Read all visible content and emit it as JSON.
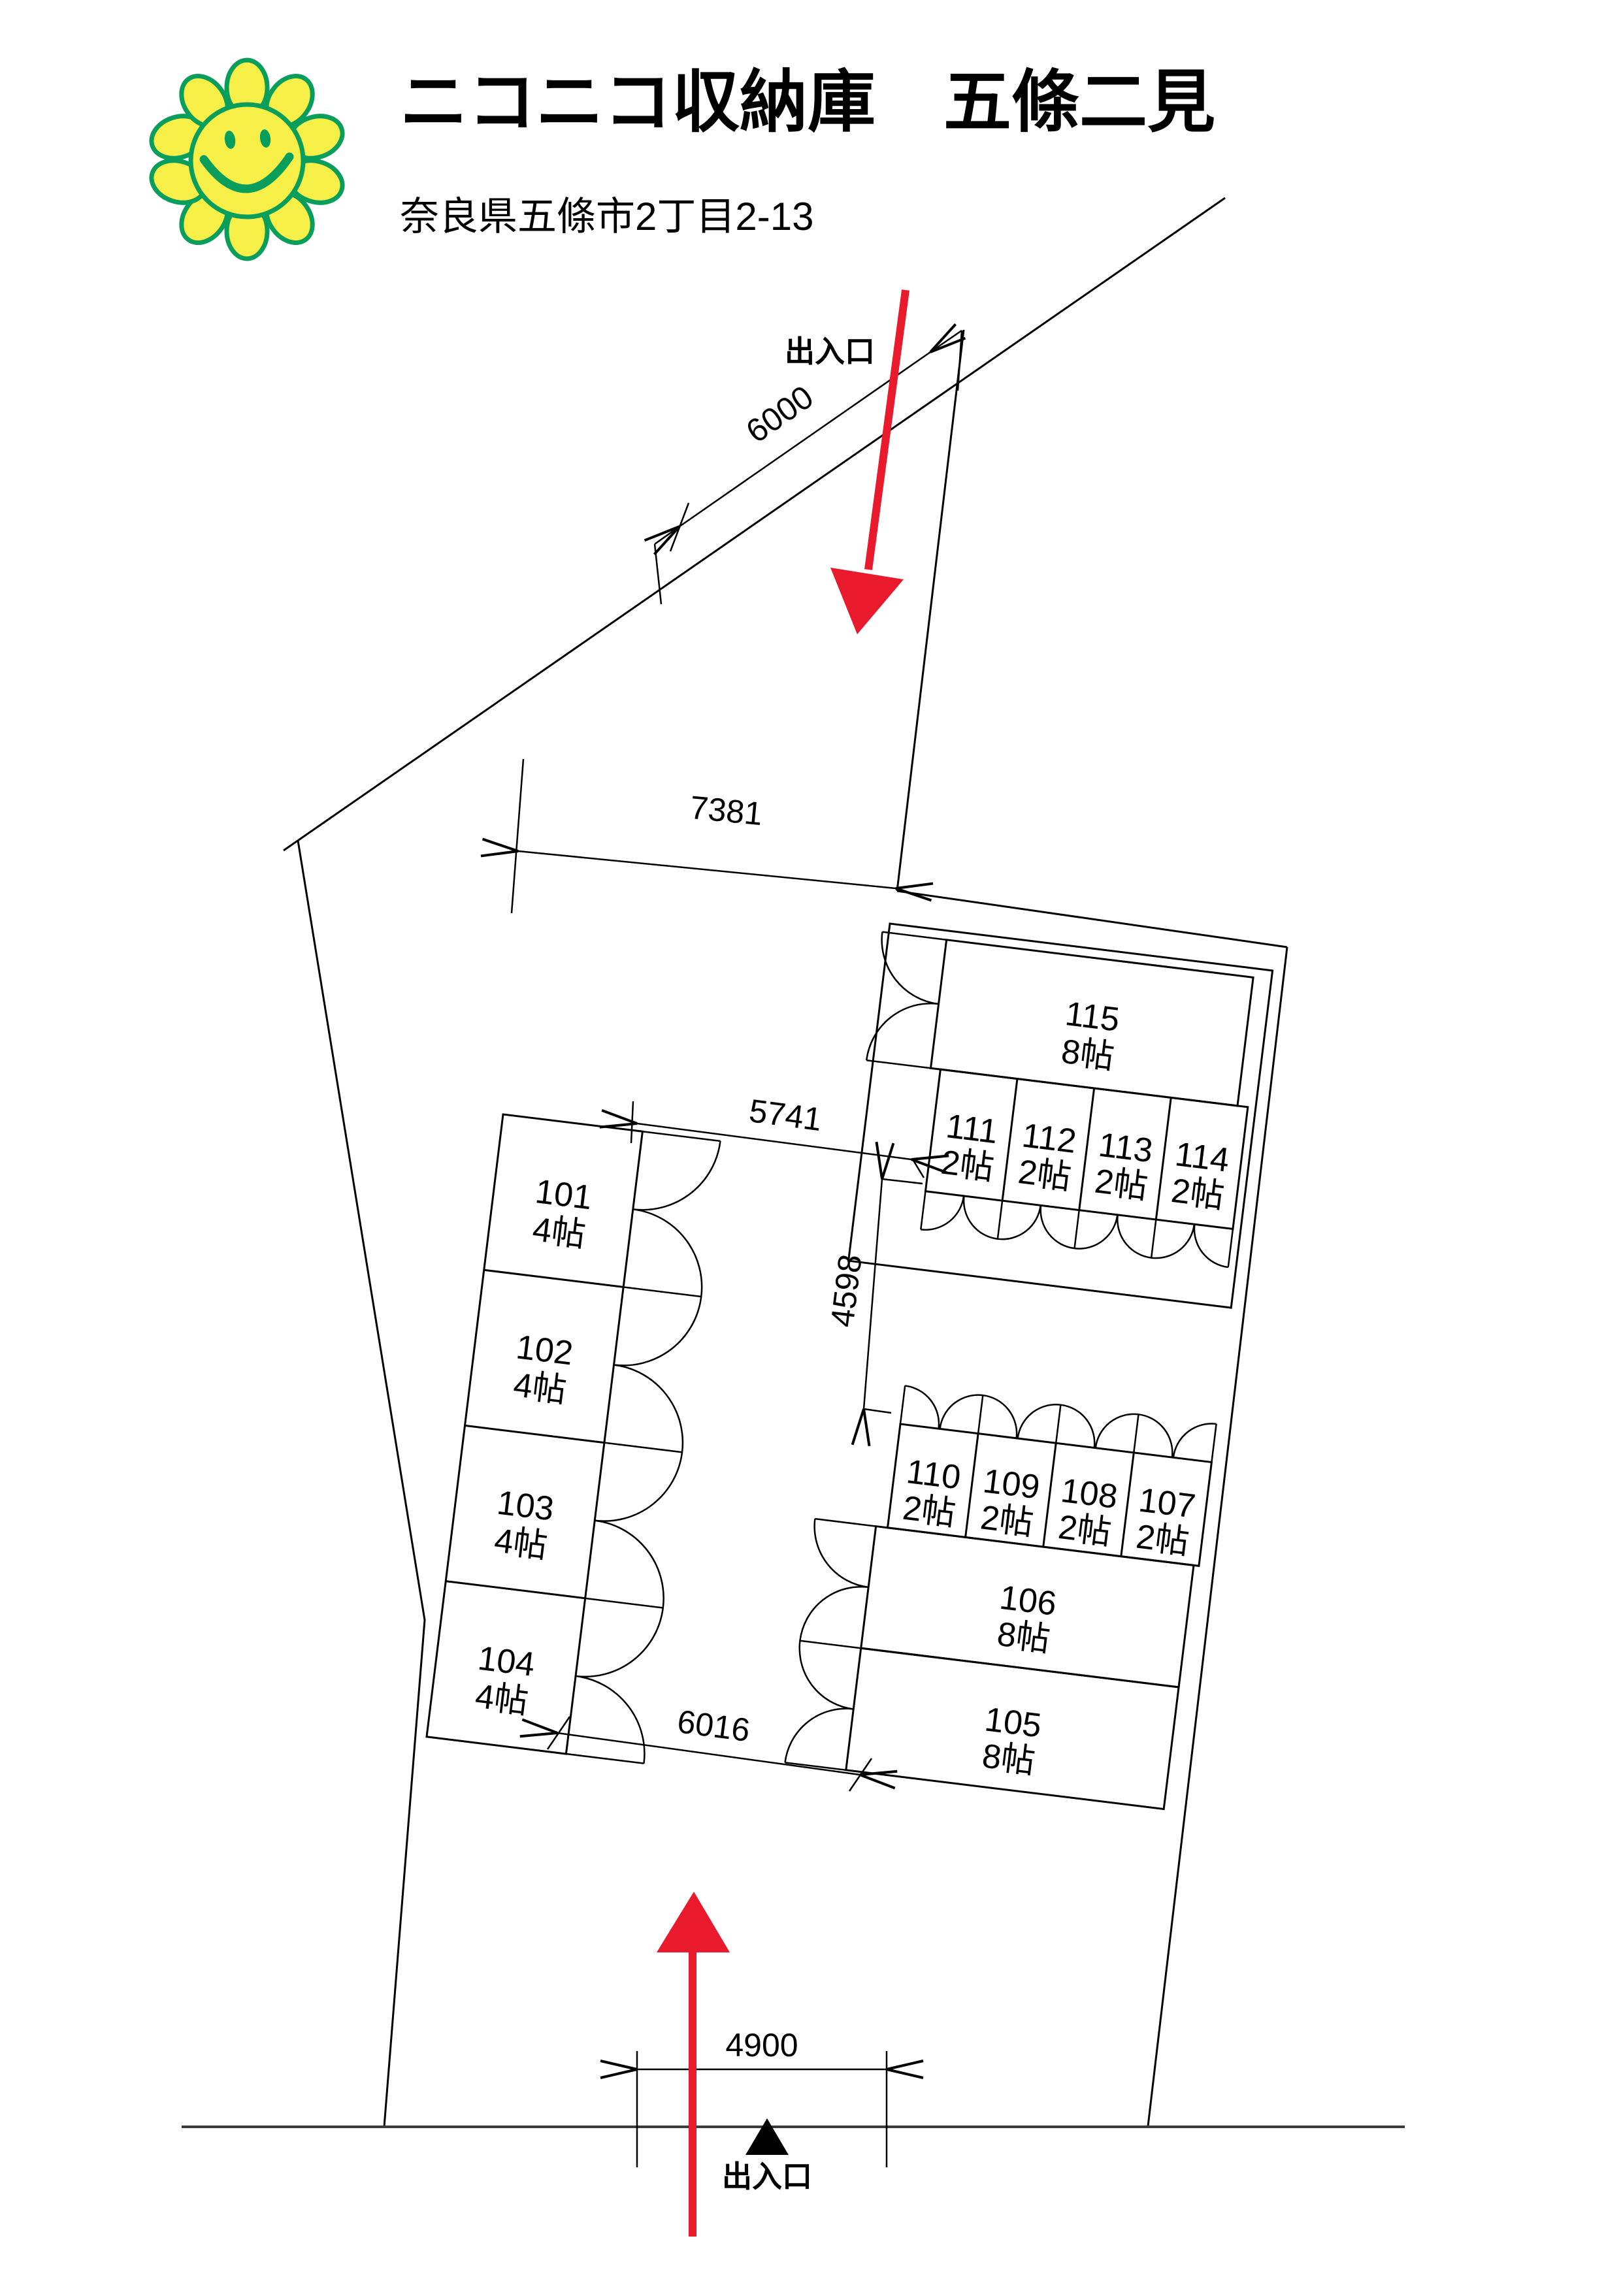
{
  "header": {
    "title": "ニコニコ収納庫　五條二見",
    "address": "奈良県五條市2丁目2-13"
  },
  "entrances": {
    "top": {
      "label": "出入口"
    },
    "bottom": {
      "label": "出入口"
    }
  },
  "dimensions": {
    "road_frontage": "6000",
    "north_width": "7381",
    "court_width": "5741",
    "court_depth": "4598",
    "south_width": "6016",
    "gate_width": "4900"
  },
  "units": [
    {
      "id": "101",
      "size": "4帖"
    },
    {
      "id": "102",
      "size": "4帖"
    },
    {
      "id": "103",
      "size": "4帖"
    },
    {
      "id": "104",
      "size": "4帖"
    },
    {
      "id": "105",
      "size": "8帖"
    },
    {
      "id": "106",
      "size": "8帖"
    },
    {
      "id": "107",
      "size": "2帖"
    },
    {
      "id": "108",
      "size": "2帖"
    },
    {
      "id": "109",
      "size": "2帖"
    },
    {
      "id": "110",
      "size": "2帖"
    },
    {
      "id": "111",
      "size": "2帖"
    },
    {
      "id": "112",
      "size": "2帖"
    },
    {
      "id": "113",
      "size": "2帖"
    },
    {
      "id": "114",
      "size": "2帖"
    },
    {
      "id": "115",
      "size": "8帖"
    }
  ],
  "colors": {
    "arrow_red": "#e81a2c",
    "logo_green": "#0a9e5c",
    "logo_yellow": "#f6ef48",
    "line": "#000000"
  }
}
